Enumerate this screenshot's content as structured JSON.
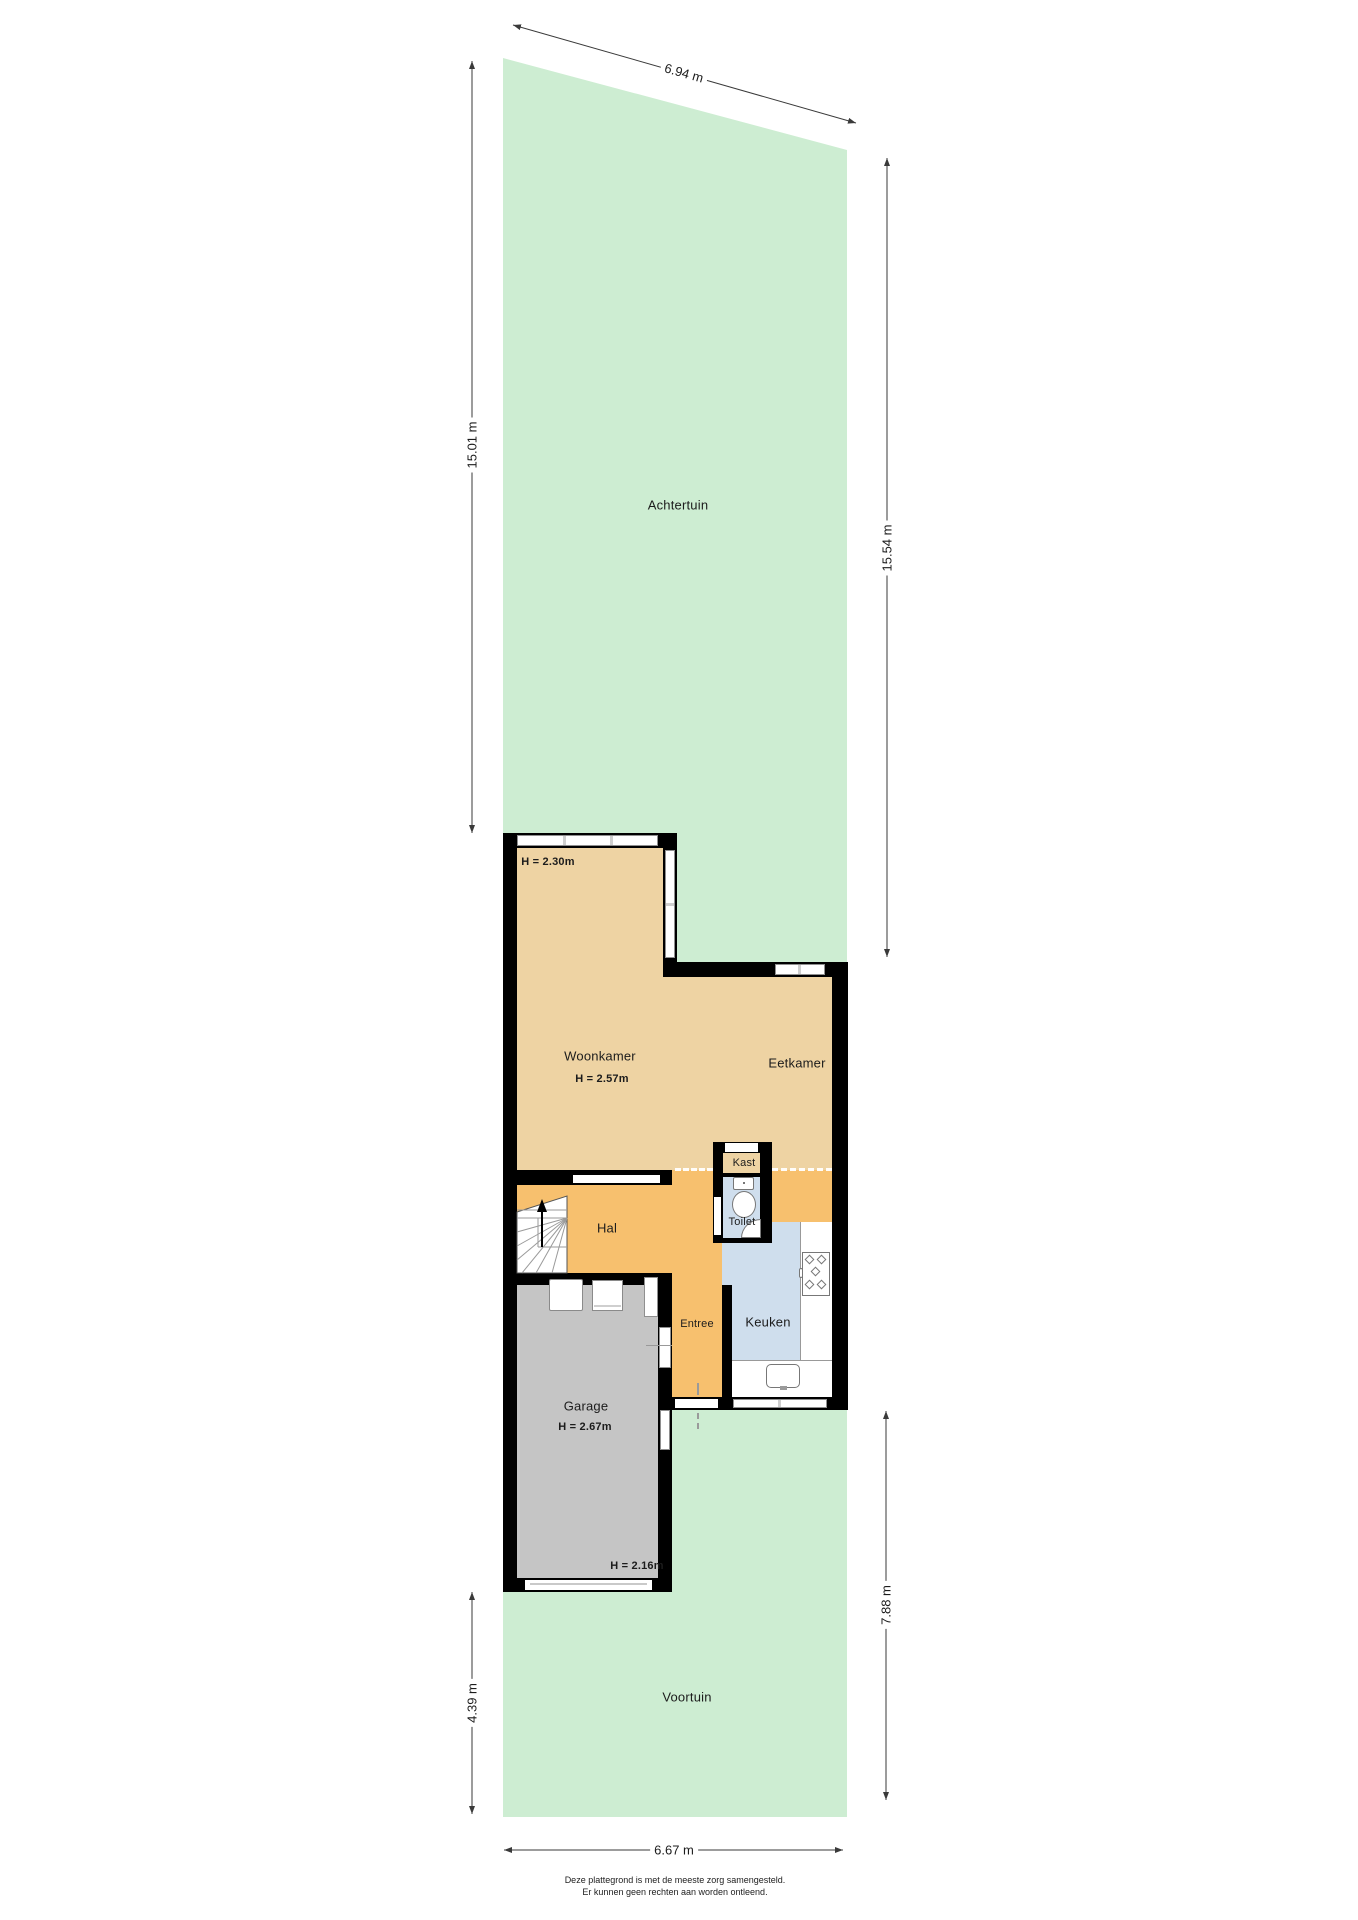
{
  "colors": {
    "garden": "#cdedd2",
    "tan": "#eed3a3",
    "orange": "#f7c06e",
    "blue": "#cfdeed",
    "garage": "#c5c5c5",
    "wall": "#000000",
    "frame": "#8f8f8f",
    "dimline": "#3a3a3a"
  },
  "garden": {
    "back_label": "Achtertuin",
    "front_label": "Voortuin"
  },
  "rooms": {
    "woonkamer": {
      "label": "Woonkamer",
      "ceiling": "H = 2.57m"
    },
    "bay": {
      "ceiling": "H = 2.30m"
    },
    "eetkamer": {
      "label": "Eetkamer"
    },
    "kast": {
      "label": "Kast"
    },
    "toilet": {
      "label": "Toilet"
    },
    "hal": {
      "label": "Hal"
    },
    "entree": {
      "label": "Entree"
    },
    "keuken": {
      "label": "Keuken"
    },
    "garage": {
      "label": "Garage",
      "ceiling": "H = 2.67m",
      "ceiling_low": "H = 2.16m"
    }
  },
  "dimensions": {
    "top": "6.94 m",
    "left_upper": "15.01 m",
    "right_upper": "15.54 m",
    "right_lower": "7.88 m",
    "left_lower": "4.39 m",
    "bottom": "6.67 m"
  },
  "disclaimer": {
    "line1": "Deze plattegrond is met de meeste zorg samengesteld.",
    "line2": "Er kunnen geen rechten aan worden ontleend."
  }
}
